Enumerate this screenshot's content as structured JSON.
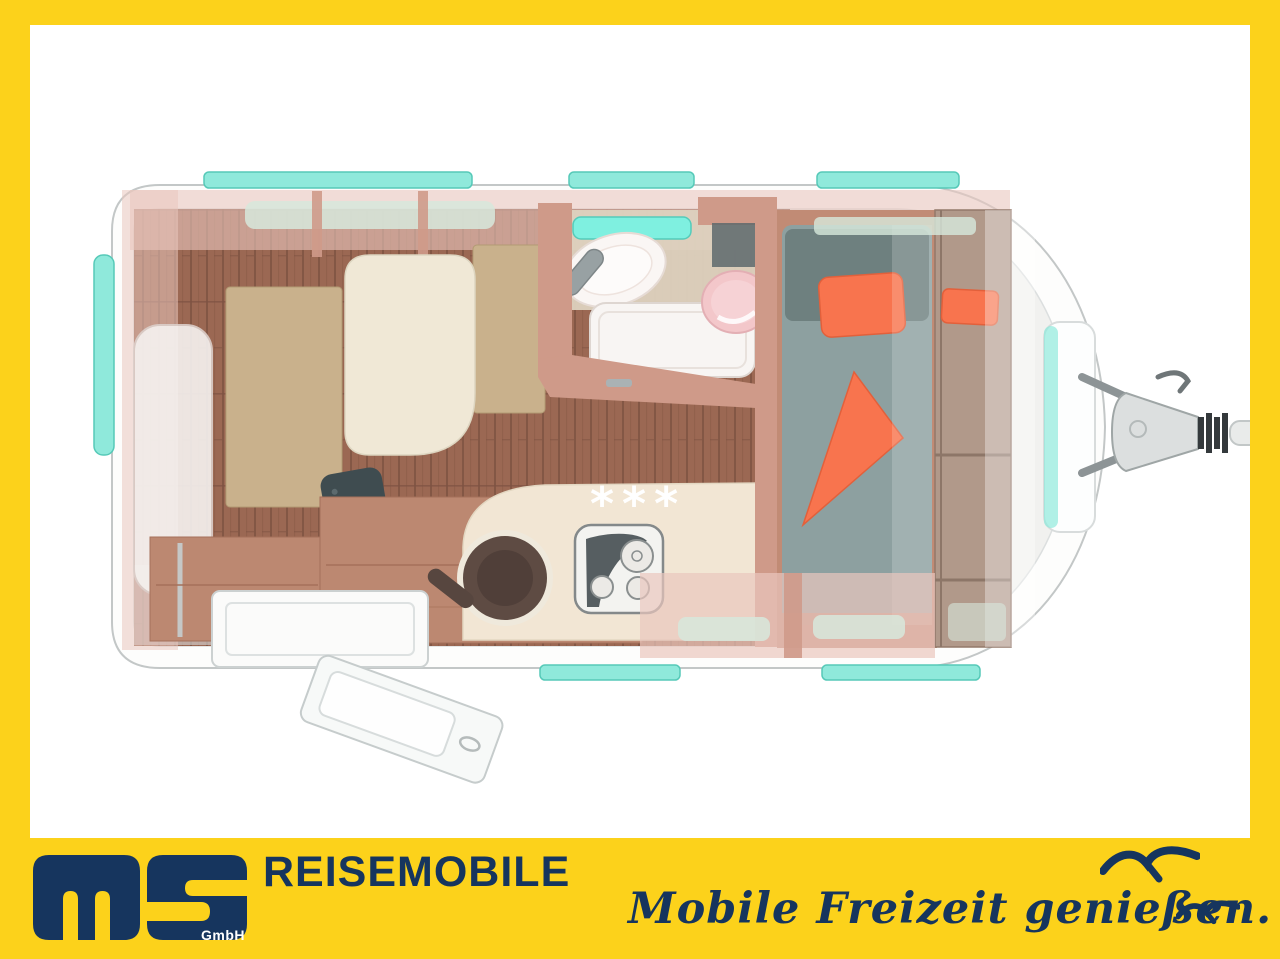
{
  "colors": {
    "frame-yellow": "#fcd21b",
    "navy": "#16355e",
    "outline": "#c3c7c7",
    "window-teal": "#8fe9db",
    "window-teal-bright": "#7ff0e0",
    "glass-green": "#d7e8dc",
    "band-pink": "#eac6be",
    "wood-light": "#cf9a89",
    "wood-mid": "#bc8871",
    "wood-dark": "#a5705a",
    "floor-wood": "#9b6853",
    "floor-line": "#7d5241",
    "cushion-tan": "#c9b18c",
    "cream": "#f0e8d6",
    "counter-cream": "#f2e6d4",
    "mattress": "#8da0a0",
    "mattress-dark": "#6e807f",
    "orange": "#f8744e",
    "pink-fixture": "#f3c7ca",
    "fixture-white": "#f8f5f3",
    "tv-dark": "#3f4c50",
    "chrome": "#9aa3a6"
  },
  "floorplan": {
    "heater_marker": "***",
    "view": "caravan top-view layout",
    "features": [
      "dinette-with-table",
      "tv-panel",
      "kitchen-counter-with-sink-and-stove",
      "bathroom-with-shower-sink-toilet",
      "single-bed-with-orange-bedding",
      "wardrobe-shelves",
      "open-entry-door",
      "trailer-hitch",
      "window-strips"
    ]
  },
  "footer": {
    "logo_company": "ms",
    "logo_suffix": "GmbH",
    "brand": "REISEMOBILE",
    "slogan": "Mobile Freizeit genießen."
  }
}
